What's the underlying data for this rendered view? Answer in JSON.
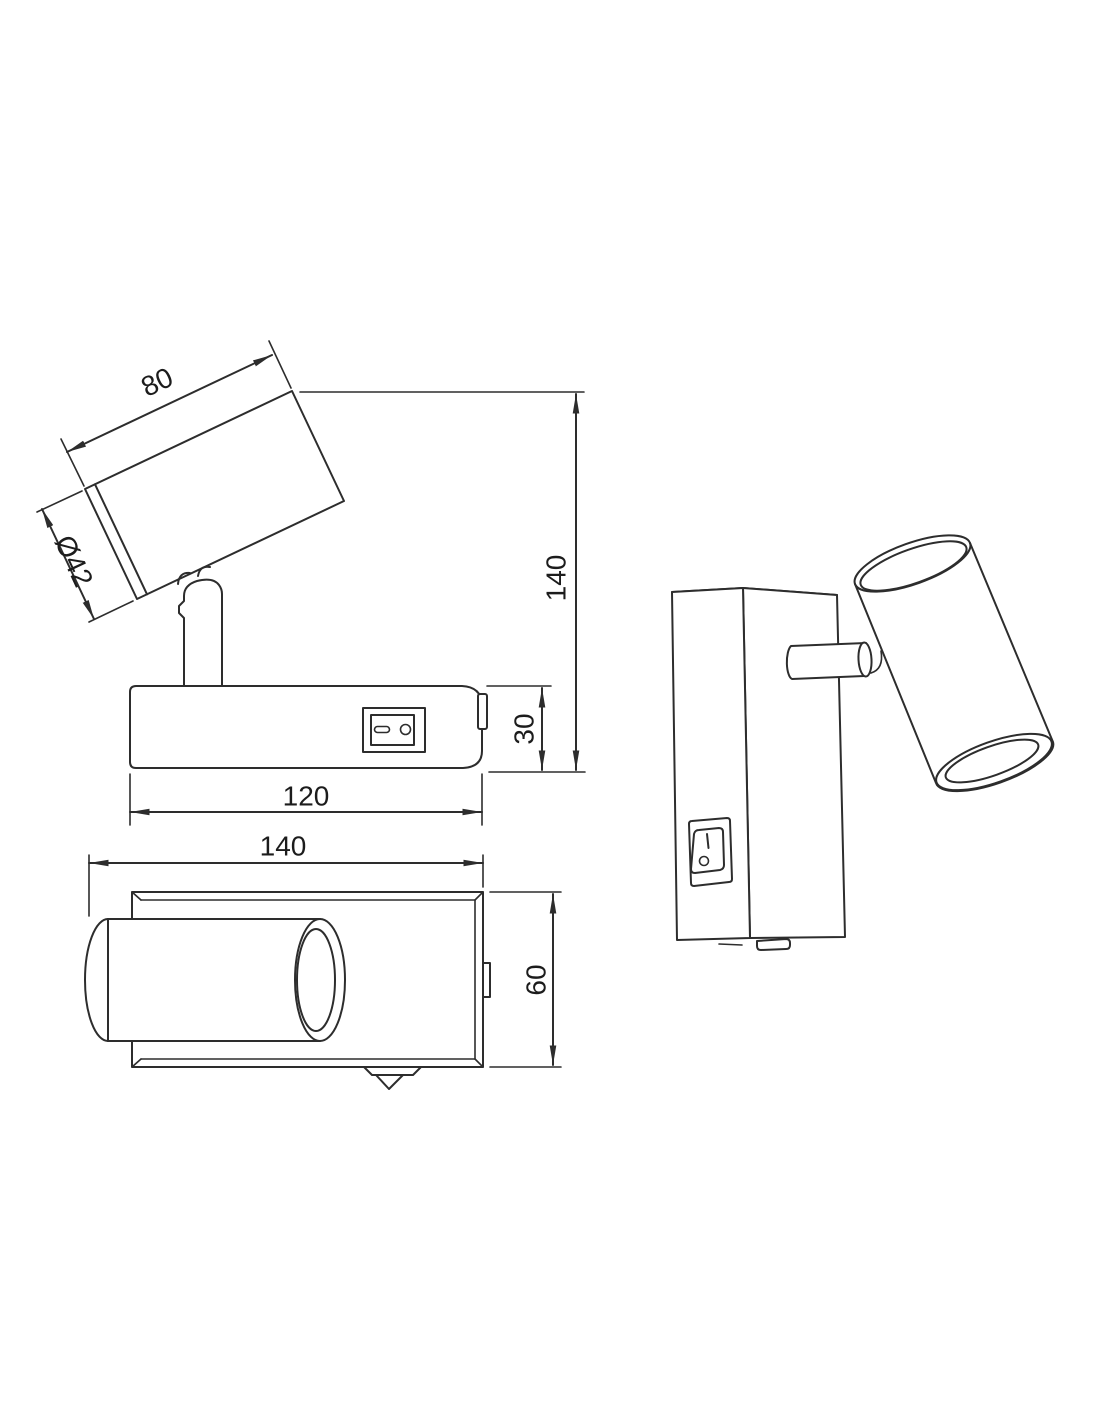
{
  "page": {
    "background": "#ffffff"
  },
  "drawing": {
    "kind": "technical dimension drawing",
    "subject": "wall-mounted spotlight with rocker switch",
    "line_color": "#2d2d2d",
    "text_color": "#1c1c1c"
  },
  "views": {
    "side": {
      "label": "side view",
      "dims": {
        "spot_length": "80",
        "spot_diameter": "Ø42",
        "total_height": "140",
        "base_height": "30",
        "base_length": "120"
      }
    },
    "top": {
      "label": "top view",
      "dims": {
        "overall_width": "140",
        "base_depth": "60"
      }
    },
    "perspective": {
      "label": "perspective view",
      "switch": {
        "on_mark": "I",
        "off_mark": "O"
      }
    }
  }
}
